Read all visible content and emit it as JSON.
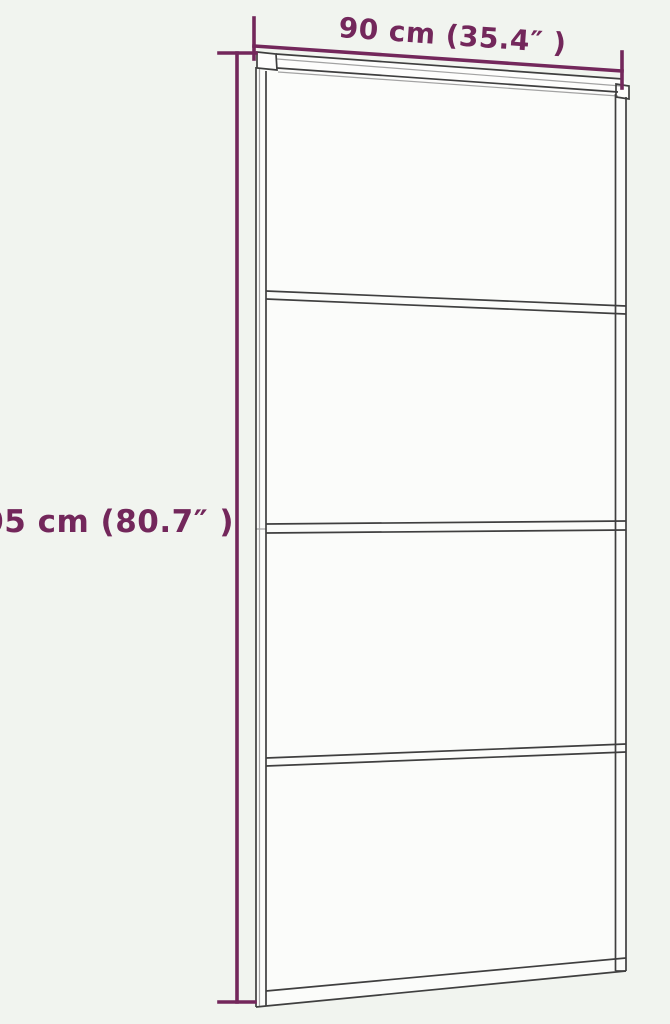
{
  "colors": {
    "background": "#f1f4ef",
    "accent": "#73275b",
    "door_line": "#3f3f3f",
    "door_line_light": "#a3a3a3",
    "glass": "#fbfcfa",
    "track_face": "#fdfdfc"
  },
  "dimension_labels": {
    "width": "90 cm (35.4″ )",
    "height": "205 cm (80.7″ )"
  }
}
